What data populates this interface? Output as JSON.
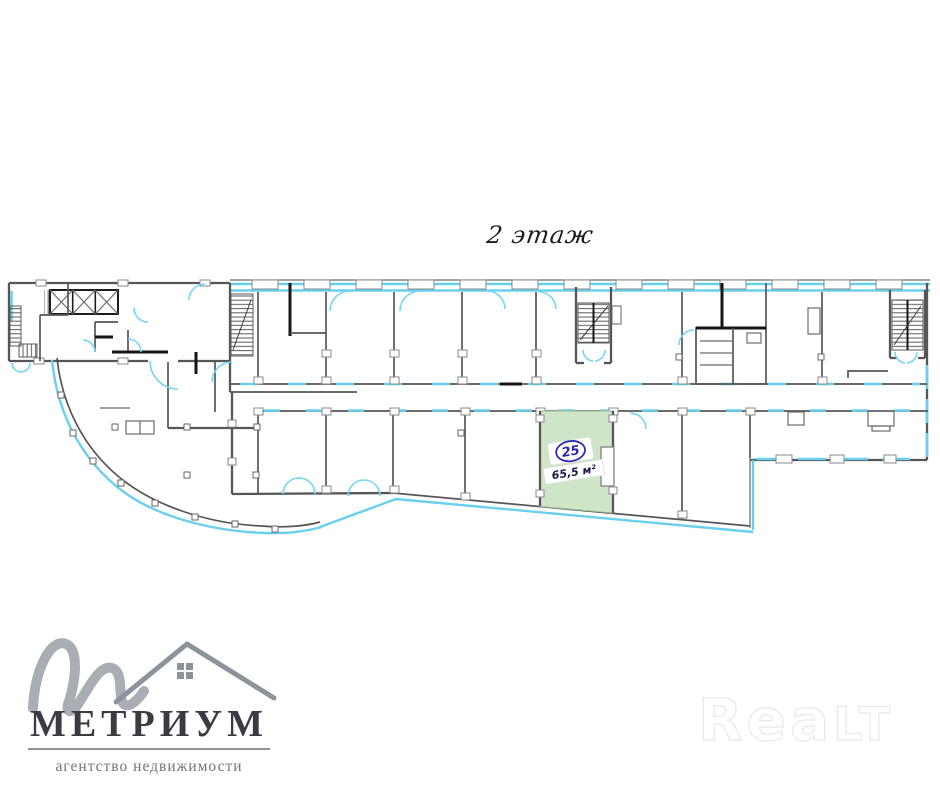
{
  "page": {
    "floor_title": "2 этаж"
  },
  "unit": {
    "number": "25",
    "area": "65,5 м²"
  },
  "logo": {
    "brand": "МЕТРИУМ",
    "tagline": "агентство недвижимости"
  },
  "watermark": {
    "part1": "Rea",
    "part2": "LT"
  },
  "colors": {
    "selected_unit_fill": "#cee5c8",
    "glass_line": "#68d0ee",
    "wall_line": "#565656",
    "unit_badge_blue": "#2b2bb4",
    "logo_gray": "#a9aeb4",
    "logo_text": "#3b3b44"
  }
}
